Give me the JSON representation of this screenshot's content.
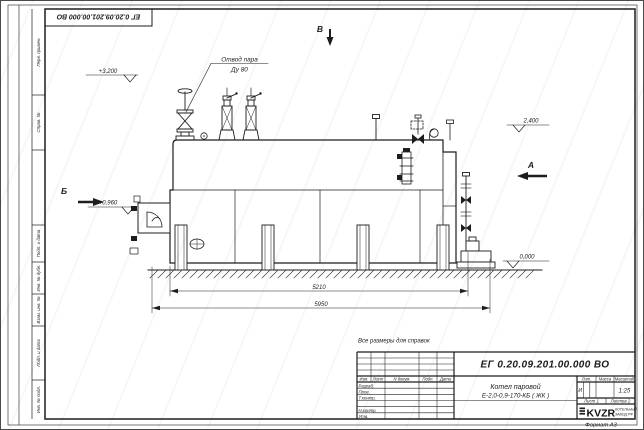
{
  "colors": {
    "line": "#1d1d1d",
    "paper": "#ffffff",
    "watermark": "#dcdce4"
  },
  "frame": {
    "inverted_designation": "ЕГ 0.20.09.201.00.000  ВО",
    "margin_labels": [
      "Перв. примен.",
      "Справ. №",
      "Подп. и дата",
      "Инв. № дубл.",
      "Взам. инв. №",
      "Подп. и дата",
      "Инв. № подл."
    ]
  },
  "annotations": {
    "callout_line1": "Отвод пара",
    "callout_line2": "Ду 80",
    "elev_top_left": "+3,200",
    "elev_right_upper": "2,400",
    "elev_left_mid": "+0,960",
    "elev_ground": "0,000",
    "view_top": "В",
    "view_right": "А",
    "view_left": "Б",
    "dim_inner": "5210",
    "dim_overall": "5950",
    "note": "Все размеры для справок"
  },
  "title_block": {
    "designation": "ЕГ 0.20.09.201.00.000  ВО",
    "name_line1": "Котел паровой",
    "name_line2": "Е-2,0-0,9-170-КБ ( ЖК )",
    "header_cols": [
      "Изм.",
      "Лист",
      "N докум.",
      "Подп.",
      "Дата"
    ],
    "roles": [
      "Разраб.",
      "Пров.",
      "Т.контр.",
      "Н.контр.",
      "Утв."
    ],
    "lit_label": "Лит.",
    "mass_label": "Масса",
    "scale_label": "Масштаб",
    "litera": "И",
    "scale_value": "1:25",
    "sheet": "Лист 1",
    "sheets": "Листов 2",
    "logo": "KVZR",
    "logo_sub1": "КОТЕЛЬНЫЙ",
    "logo_sub2": "ЗАВОД РФ",
    "format": "Формат А3"
  }
}
